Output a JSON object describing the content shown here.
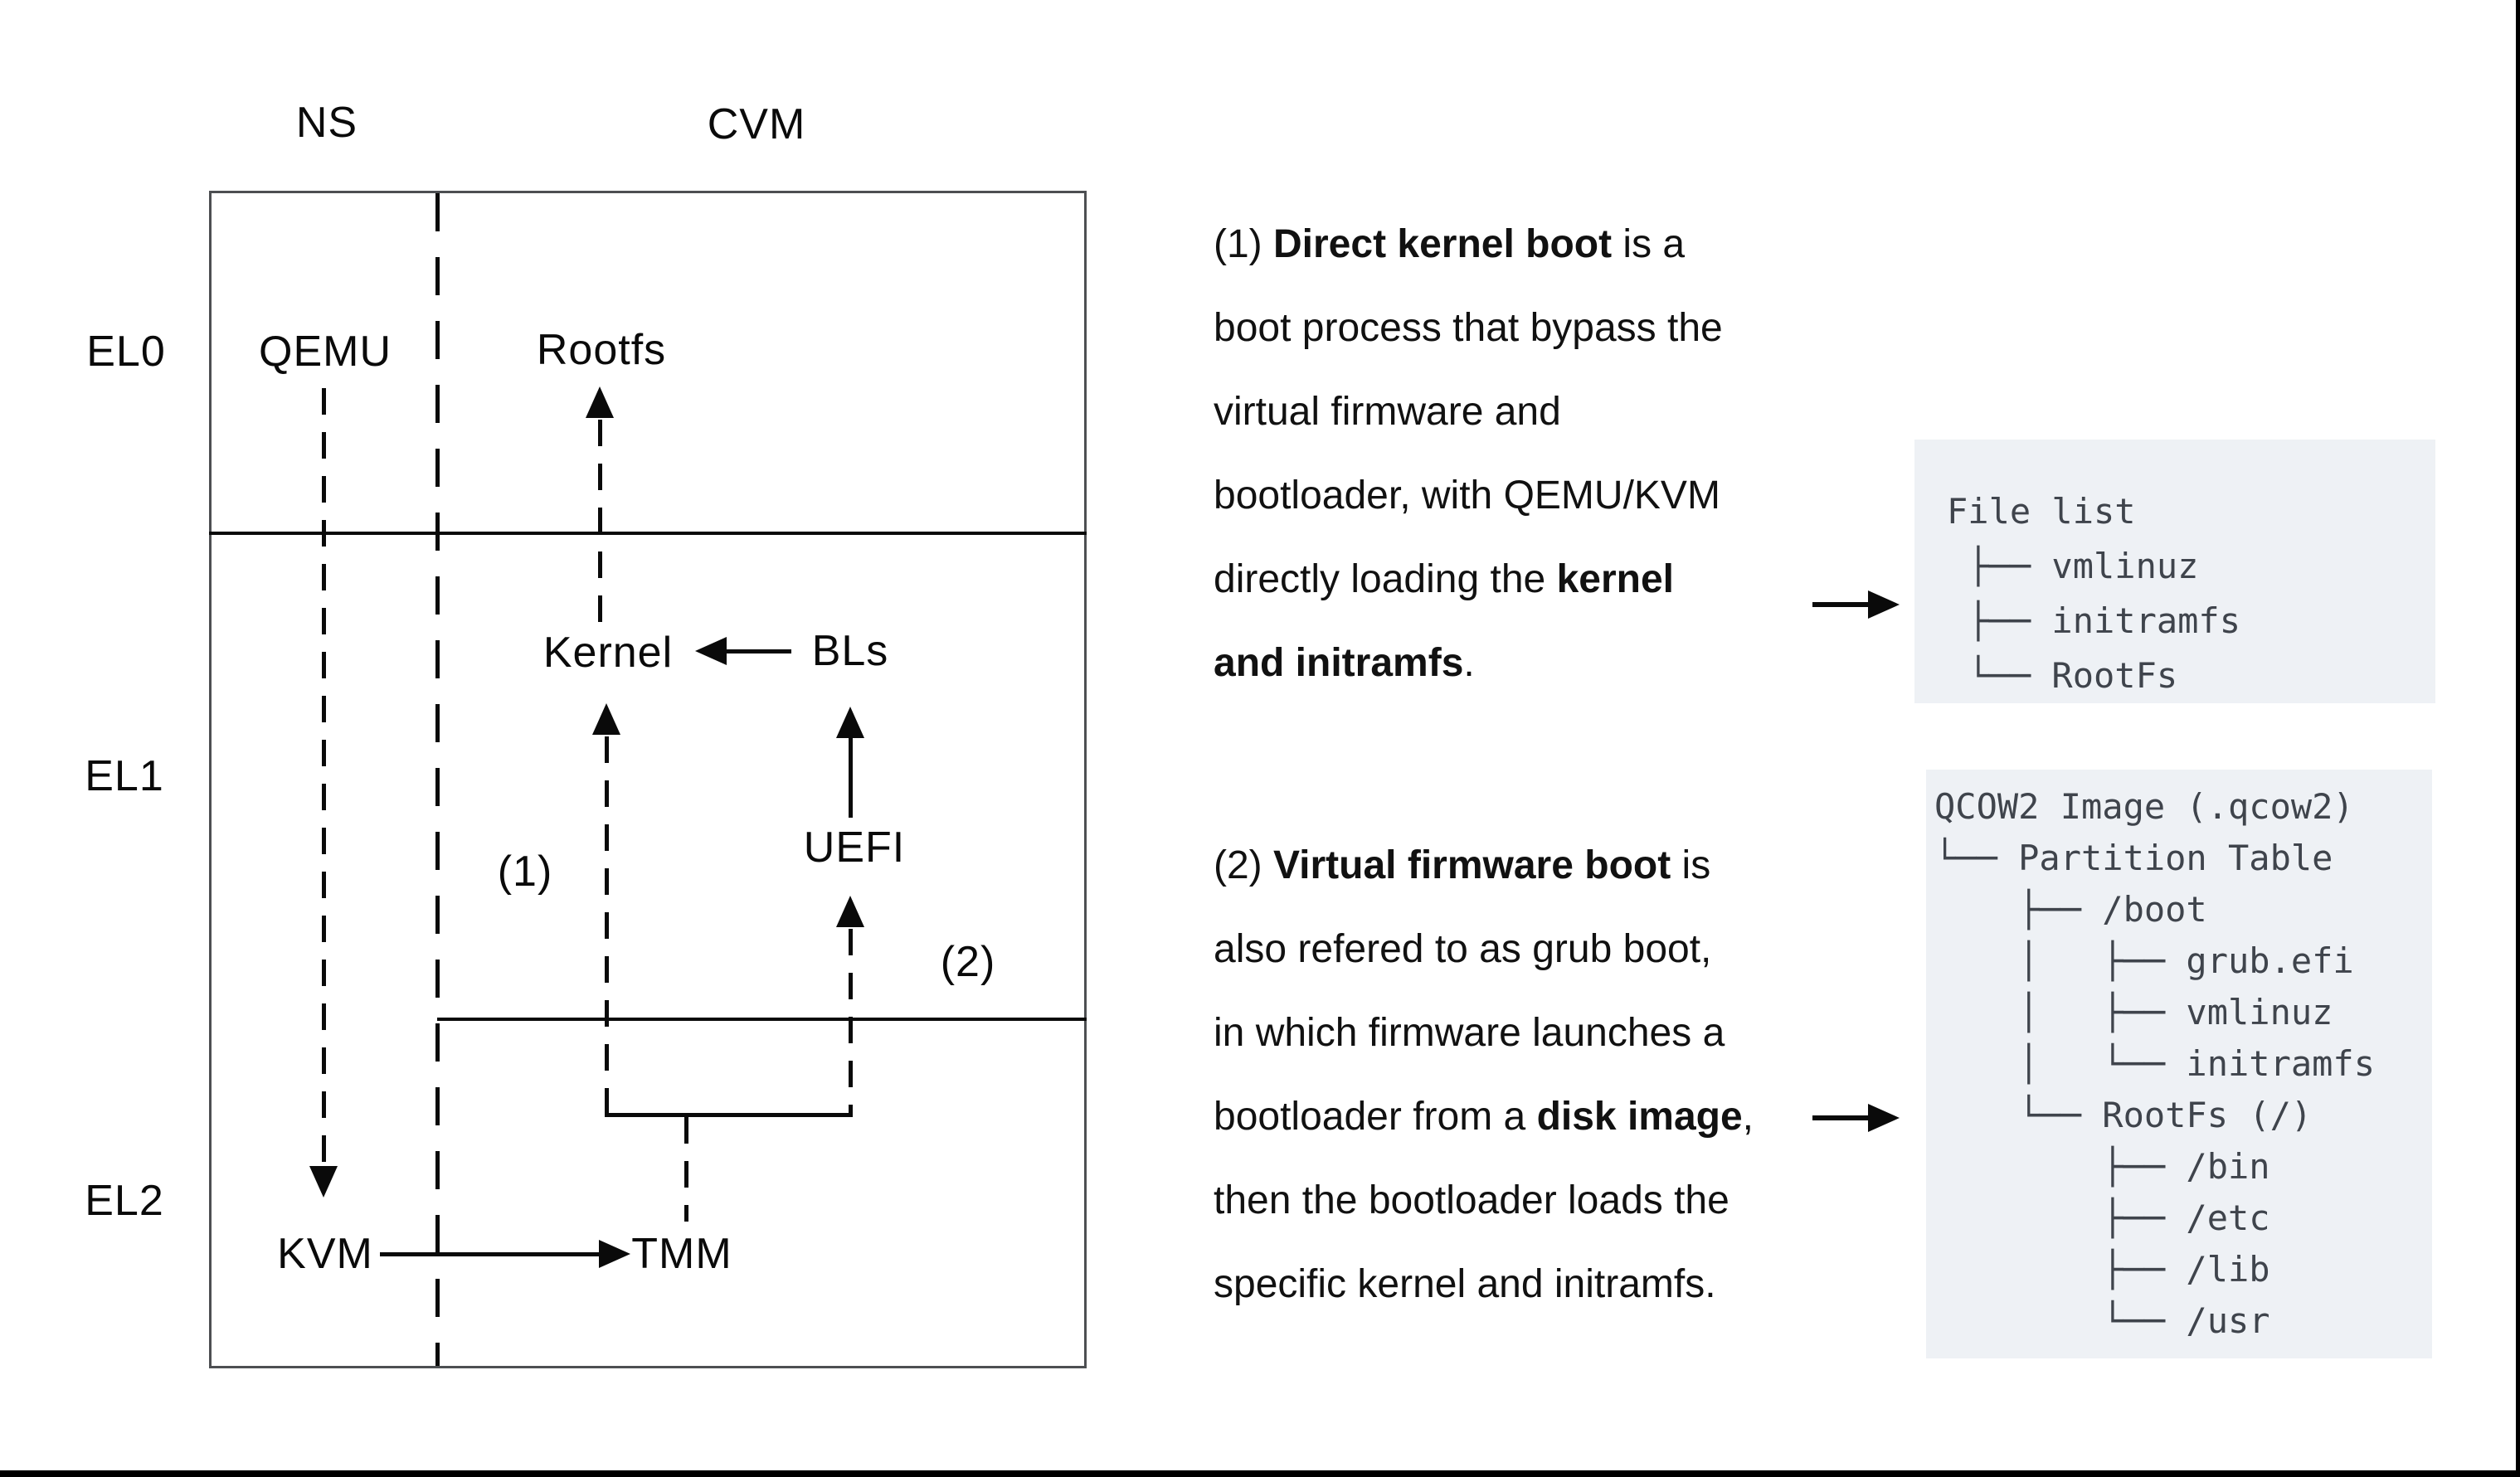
{
  "diagram": {
    "columns": {
      "ns": "NS",
      "cvm": "CVM"
    },
    "rows": {
      "el0": "EL0",
      "el1": "EL1",
      "el2": "EL2"
    },
    "nodes": {
      "qemu": "QEMU",
      "rootfs": "Rootfs",
      "kernel": "Kernel",
      "bls": "BLs",
      "uefi": "UEFI",
      "kvm": "KVM",
      "tmm": "TMM"
    },
    "path_labels": {
      "path1": "(1)",
      "path2": "(2)"
    }
  },
  "annotations": {
    "para1": {
      "lines": [
        {
          "pre": "(1) ",
          "bold": "Direct kernel boot",
          "post": " is a"
        },
        {
          "pre": "boot process that bypass the",
          "bold": "",
          "post": ""
        },
        {
          "pre": "virtual firmware and",
          "bold": "",
          "post": ""
        },
        {
          "pre": "bootloader, with QEMU/KVM",
          "bold": "",
          "post": ""
        },
        {
          "pre": "directly loading the ",
          "bold": "kernel",
          "post": ""
        },
        {
          "pre": "",
          "bold": "and initramfs",
          "post": "."
        }
      ]
    },
    "para2": {
      "lines": [
        {
          "pre": "(2) ",
          "bold": "Virtual firmware boot",
          "post": " is"
        },
        {
          "pre": "also refered to as grub boot,",
          "bold": "",
          "post": ""
        },
        {
          "pre": "in which firmware launches a",
          "bold": "",
          "post": ""
        },
        {
          "pre": "bootloader from a ",
          "bold": "disk image",
          "post": ","
        },
        {
          "pre": "then the bootloader loads the",
          "bold": "",
          "post": ""
        },
        {
          "pre": "specific kernel and initramfs.",
          "bold": "",
          "post": ""
        }
      ]
    }
  },
  "file_boxes": {
    "direct_boot": {
      "lines": [
        "File list",
        " ├── vmlinuz",
        " ├── initramfs",
        " └── RootFs"
      ]
    },
    "qcow2": {
      "lines": [
        "QCOW2 Image (.qcow2)",
        "└── Partition Table",
        "    ├── /boot",
        "    │   ├── grub.efi",
        "    │   ├── vmlinuz",
        "    │   └── initramfs",
        "    └── RootFs (/)",
        "        ├── /bin",
        "        ├── /etc",
        "        ├── /lib",
        "        └── /usr"
      ]
    }
  },
  "colors": {
    "callout_bg": "#eef1f5",
    "callout_text": "#3f444c",
    "diagram_border": "#4d4f52",
    "line": "#0a0a0a"
  }
}
